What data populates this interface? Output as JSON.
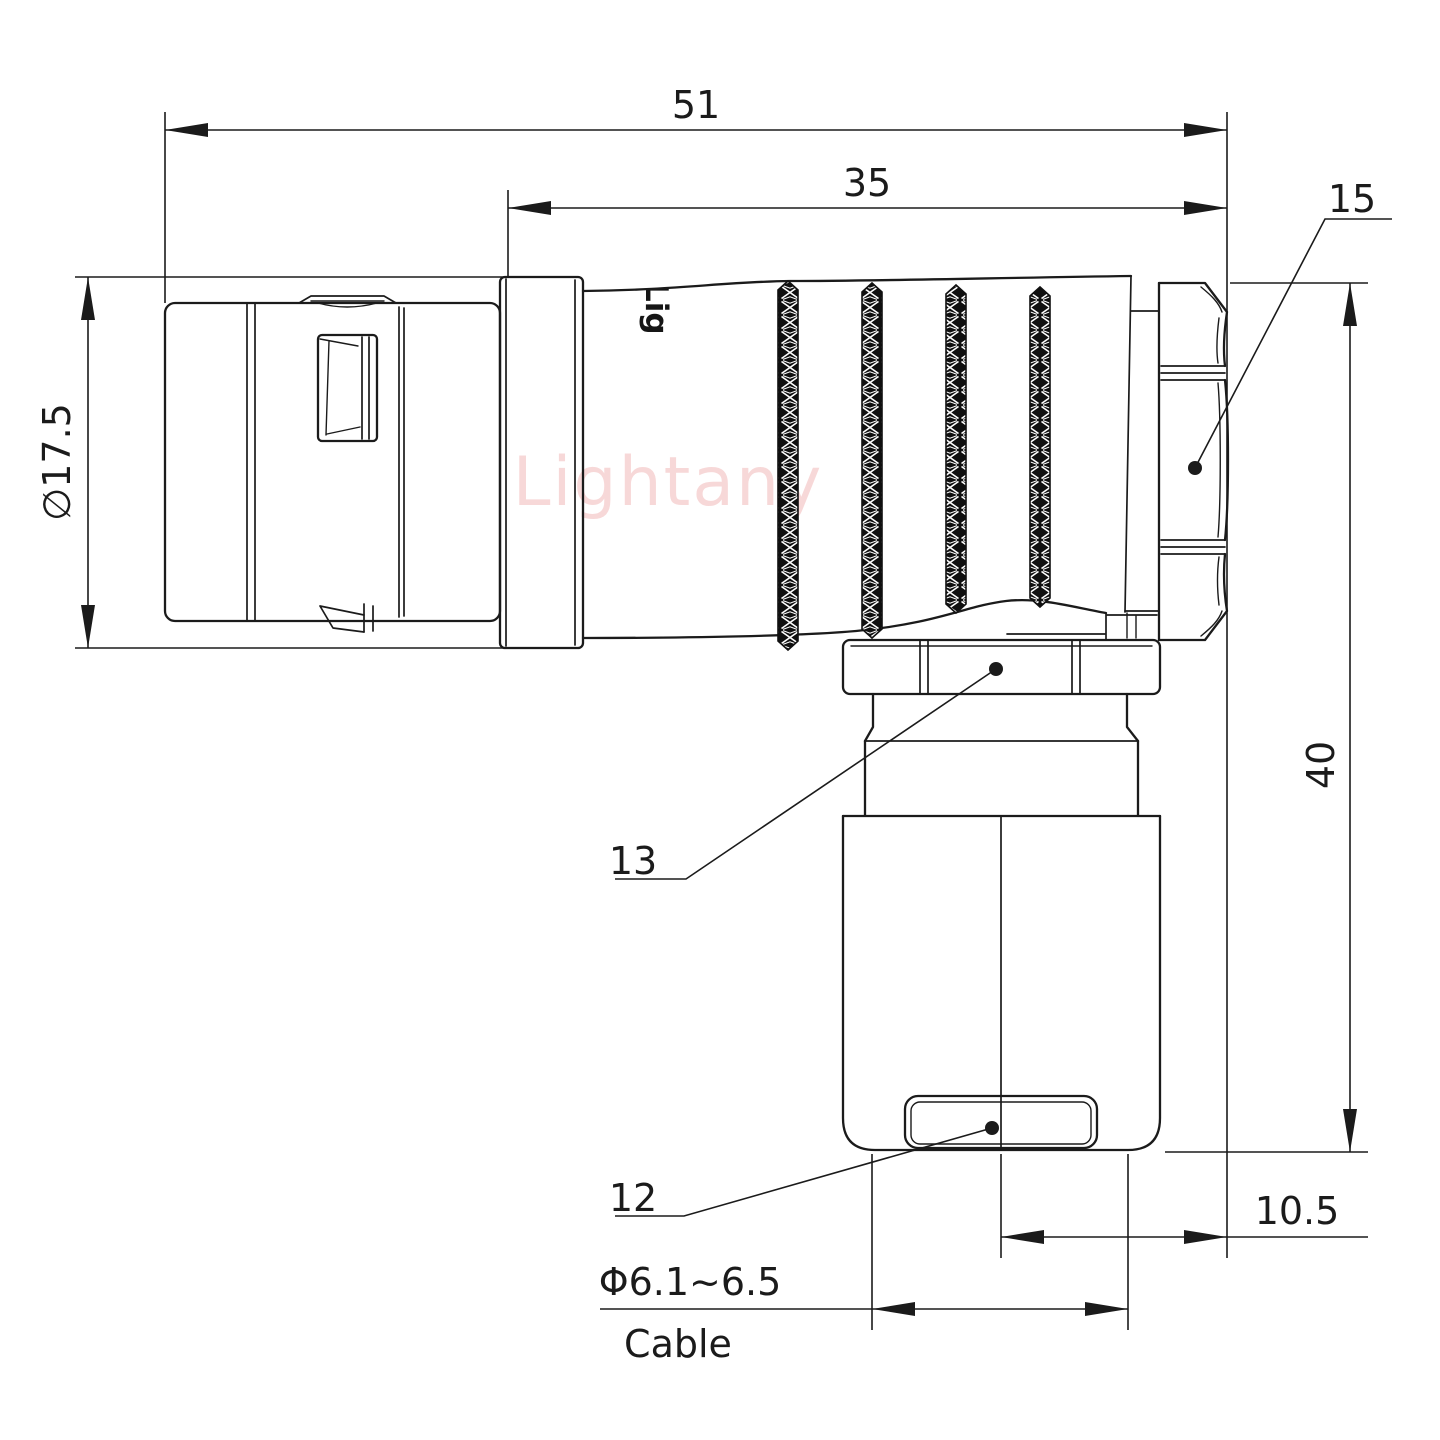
{
  "dimensions": {
    "overall_length": "51",
    "grip_length": "35",
    "backnut_ref": "15",
    "shell_diameter": "∅17.5",
    "elbow_height": "40",
    "cable_offset": "10.5",
    "cable_diameter": "Φ6.1~6.5",
    "cable_word": "Cable",
    "coupling_nut_ref": "13",
    "bend_relief_ref": "12"
  },
  "branding": {
    "watermark": "Lightany",
    "engraving": "Lig"
  },
  "colors": {
    "line": "#1b1b1b",
    "watermark": "#f2b9b9",
    "background": "#ffffff"
  }
}
